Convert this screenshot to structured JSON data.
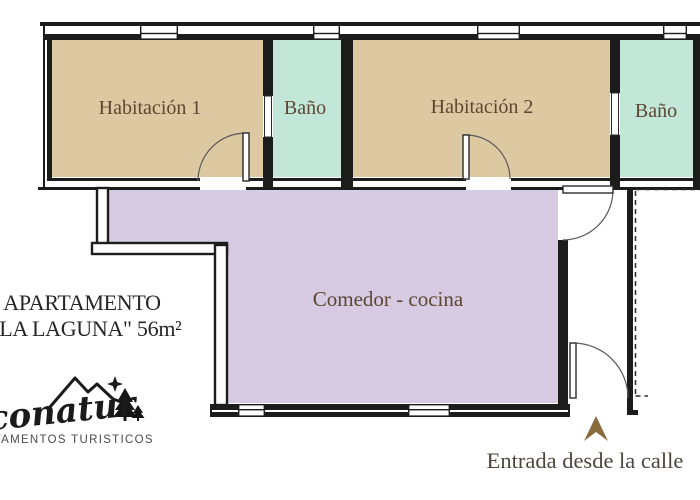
{
  "plan": {
    "rooms": [
      {
        "name": "habitacion-1",
        "label": "Habitación 1"
      },
      {
        "name": "bano-1",
        "label": "Baño"
      },
      {
        "name": "habitacion-2",
        "label": "Habitación 2"
      },
      {
        "name": "bano-2",
        "label": "Baño"
      },
      {
        "name": "comedor-cocina",
        "label": "Comedor - cocina"
      }
    ],
    "entrance": {
      "label": "Entrada desde la calle",
      "arrow_icon": "up-arrow"
    }
  },
  "title": {
    "line1": "APARTAMENTO",
    "line2": "\"LA LAGUNA\" 56m²"
  },
  "logo": {
    "brand": "Econatur",
    "tagline": "APARTAMENTOS TURISTICOS"
  },
  "colors": {
    "bedroom_fill": "#dcc8a1",
    "bathroom_fill": "#c2e6d7",
    "living_fill": "#d7cae3",
    "wall": "#1c1c1c",
    "room_label_text": "#5d4733",
    "entrance_text": "#4e463c",
    "entrance_arrow": "#8a6c3e",
    "title_text": "#262626",
    "logo_text": "#1a1a1a",
    "tagline_text": "#4c4c4c",
    "background": "#ffffff"
  }
}
